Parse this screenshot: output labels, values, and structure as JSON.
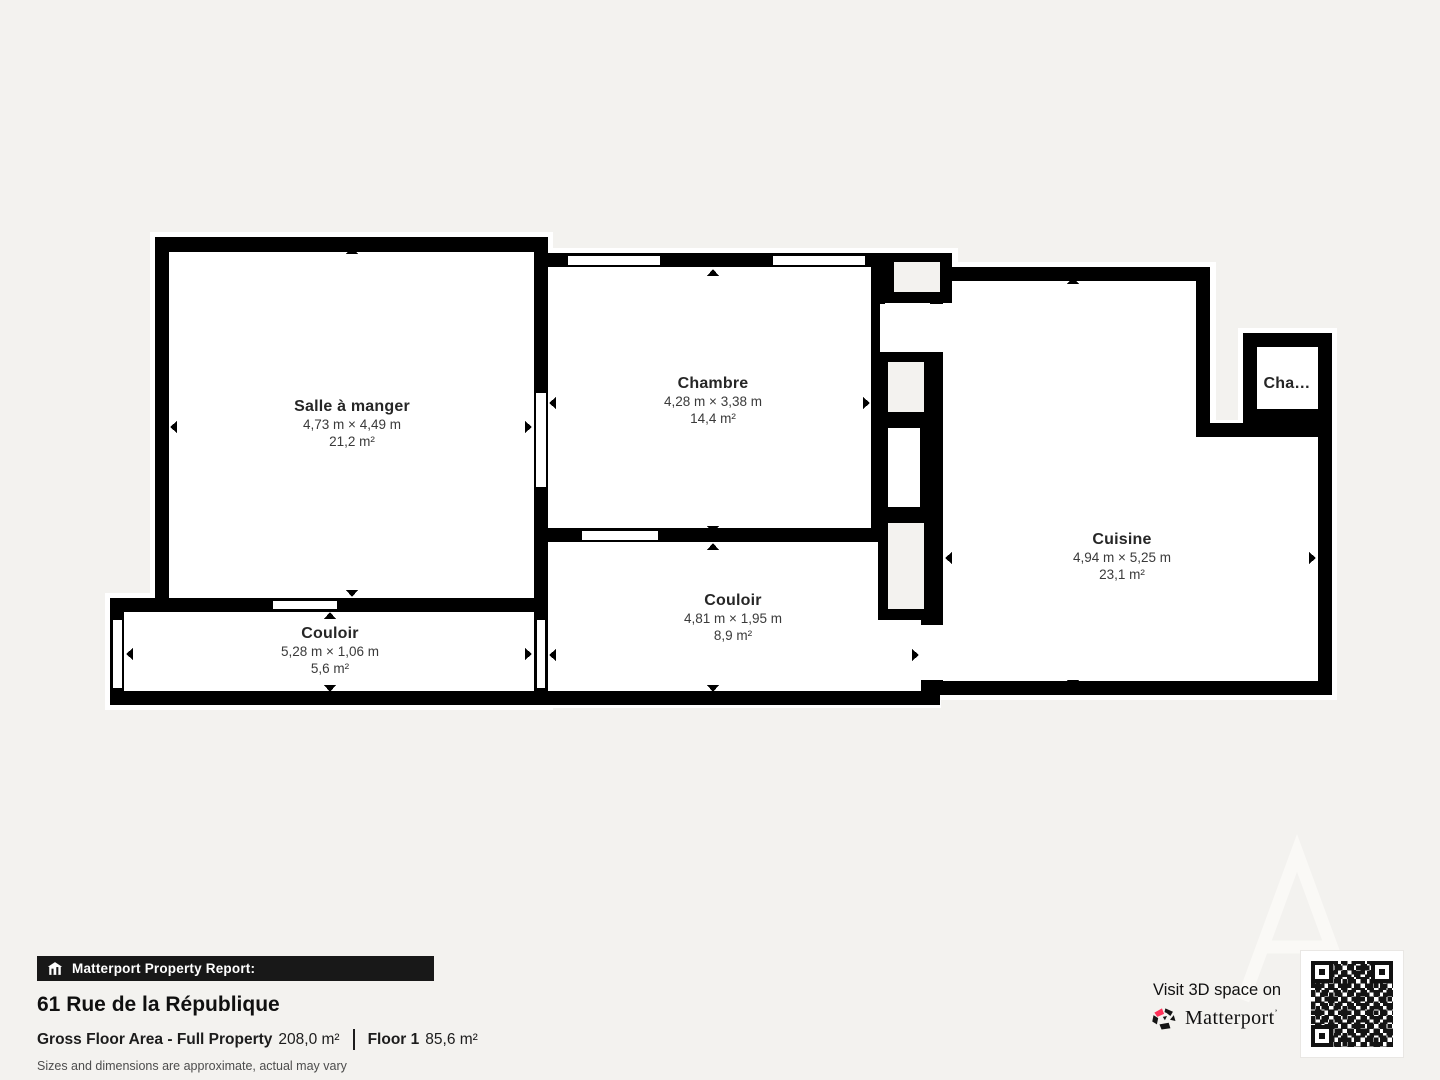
{
  "colors": {
    "background": "#f3f2ef",
    "wall": "#000000",
    "room_fill": "#ffffff",
    "accent_pink": "#ff3158",
    "report_bar_bg": "#181818",
    "watermark": "#faf9f6"
  },
  "floorplan": {
    "rooms": [
      {
        "name": "Salle à manger",
        "dimensions": "4,73 m × 4,49 m",
        "area": "21,2 m²"
      },
      {
        "name": "Chambre",
        "dimensions": "4,28 m × 3,38 m",
        "area": "14,4 m²"
      },
      {
        "name": "Cuisine",
        "dimensions": "4,94 m × 5,25 m",
        "area": "23,1 m²"
      },
      {
        "name": "Couloir",
        "dimensions": "5,28 m × 1,06 m",
        "area": "5,6 m²"
      },
      {
        "name": "Couloir",
        "dimensions": "4,81 m × 1,95 m",
        "area": "8,9 m²"
      },
      {
        "name": "Cha…"
      }
    ]
  },
  "report": {
    "bar_title": "Matterport Property Report:",
    "address": "61 Rue de la République",
    "gfa_label": "Gross Floor Area - Full Property",
    "gfa_value": "208,0 m²",
    "floor_label": "Floor 1",
    "floor_value": "85,6 m²",
    "disclaimer": "Sizes and dimensions are approximate, actual may vary"
  },
  "promo": {
    "visit_text": "Visit 3D space on",
    "brand": "Matterport",
    "trademark": "’"
  }
}
